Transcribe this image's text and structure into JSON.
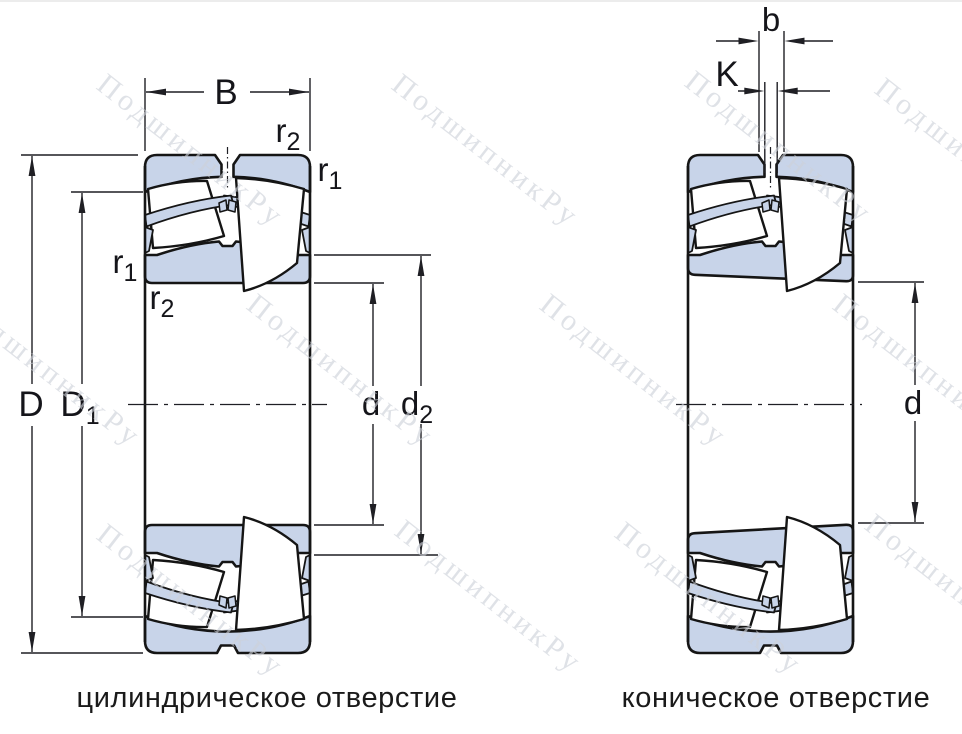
{
  "watermark": {
    "text": "ПодшипникРу"
  },
  "figures": {
    "left": {
      "caption": "цилиндрическое отверстие",
      "labels": {
        "B": "B",
        "r2_top": {
          "base": "r",
          "sub": "2"
        },
        "r1_right": {
          "base": "r",
          "sub": "1"
        },
        "r1_left": {
          "base": "r",
          "sub": "1"
        },
        "r2_left": {
          "base": "r",
          "sub": "2"
        },
        "D": "D",
        "D1": {
          "base": "D",
          "sub": "1"
        },
        "d": "d",
        "d2": {
          "base": "d",
          "sub": "2"
        }
      }
    },
    "right": {
      "caption": "коническое отверстие",
      "labels": {
        "b": "b",
        "K": "K",
        "d": "d"
      }
    }
  },
  "colors": {
    "ring_fill": "#c8d4e9",
    "outline": "#151515",
    "dimension": "#1f1f24",
    "watermark": "#cdd1d9",
    "caption_text": "#1a1a1a",
    "top_border": "#ececec"
  }
}
